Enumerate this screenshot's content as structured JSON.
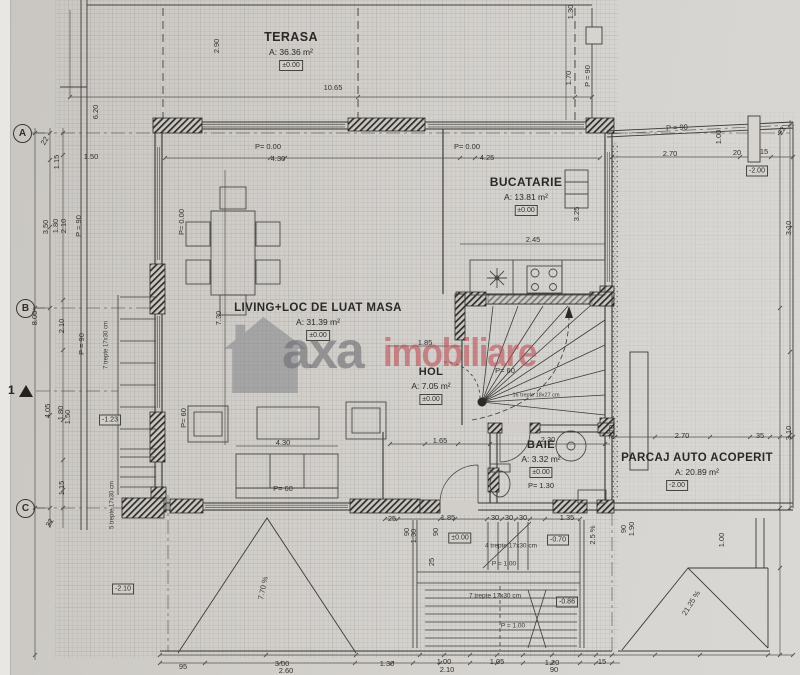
{
  "watermark": {
    "gray": "axa",
    "red": "imobiliare"
  },
  "section": {
    "label": "1"
  },
  "axes": [
    {
      "label": "A",
      "x": 22,
      "y": 133
    },
    {
      "label": "B",
      "x": 25,
      "y": 308
    },
    {
      "label": "C",
      "x": 25,
      "y": 508
    }
  ],
  "rooms": [
    {
      "key": "terasa",
      "name": "TERASA",
      "area": "A: 36.36 m²",
      "level": "±0.00",
      "x": 291,
      "y": 38,
      "size": 12.5
    },
    {
      "key": "bucatarie",
      "name": "BUCATARIE",
      "area": "A: 13.81 m²",
      "level": "±0.00",
      "x": 526,
      "y": 183,
      "size": 12
    },
    {
      "key": "living",
      "name": "LIVING+LOC DE LUAT MASA",
      "area": "A: 31.39 m²",
      "level": "±0.00",
      "x": 318,
      "y": 310,
      "size": 11.5
    },
    {
      "key": "hol",
      "name": "HOL",
      "area": "A: 7.05 m²",
      "level": "±0.00",
      "x": 431,
      "y": 374,
      "size": 11
    },
    {
      "key": "baie",
      "name": "BAIE",
      "area": "A: 3.32 m²",
      "level": "±0.00",
      "extra": "P= 1.30",
      "x": 541,
      "y": 447,
      "size": 11
    },
    {
      "key": "parcaj",
      "name": "PARCAJ AUTO ACOPERIT",
      "area": "A: 20.89 m²",
      "level": "-2.00",
      "x": 697,
      "y": 460,
      "size": 11.5,
      "level_dx": -20
    }
  ],
  "levels": [
    {
      "t": "-1.23",
      "x": 110,
      "y": 420
    },
    {
      "t": "-2.10",
      "x": 123,
      "y": 589
    },
    {
      "t": "±0.00",
      "x": 460,
      "y": 538
    },
    {
      "t": "-0.70",
      "x": 558,
      "y": 540
    },
    {
      "t": "-0.86",
      "x": 567,
      "y": 602
    },
    {
      "t": "-2.00",
      "x": 757,
      "y": 171
    }
  ],
  "annotations": [
    {
      "t": "16 trepte 18x27 cm",
      "x": 536,
      "y": 396,
      "s": 5.5
    },
    {
      "t": "4 trepte 17x30 cm",
      "x": 511,
      "y": 546,
      "s": 6.5
    },
    {
      "t": "P = 1.00",
      "x": 504,
      "y": 564,
      "s": 6.5
    },
    {
      "t": "7 trepte 17x30 cm",
      "x": 495,
      "y": 596,
      "s": 6.5
    },
    {
      "t": "P = 1.00",
      "x": 513,
      "y": 626,
      "s": 6.5
    },
    {
      "t": "7 trepte 17x30 cm",
      "x": 107,
      "y": 345,
      "r": -90,
      "s": 6
    },
    {
      "t": "5 trepte 17x30 cm",
      "x": 113,
      "y": 505,
      "r": -90,
      "s": 6
    },
    {
      "t": "7.70 %",
      "x": 263,
      "y": 588,
      "r": -78,
      "s": 7.5
    },
    {
      "t": "21.25 %",
      "x": 691,
      "y": 603,
      "r": -58,
      "s": 7.5
    }
  ],
  "dimensions": [
    {
      "t": "10.65",
      "x": 333,
      "y": 88
    },
    {
      "t": "2.90",
      "x": 217,
      "y": 46,
      "r": -90
    },
    {
      "t": "6.20",
      "x": 96,
      "y": 112,
      "r": -90
    },
    {
      "t": "1.50",
      "x": 91,
      "y": 157
    },
    {
      "t": "22",
      "x": 45,
      "y": 141,
      "r": -60
    },
    {
      "t": "1.15",
      "x": 57,
      "y": 162,
      "r": -90
    },
    {
      "t": "3.50",
      "x": 46,
      "y": 227,
      "r": -90
    },
    {
      "t": "1.80",
      "x": 56,
      "y": 226,
      "r": -90
    },
    {
      "t": "2.10",
      "x": 64,
      "y": 226,
      "r": -90
    },
    {
      "t": "P = 90",
      "x": 79,
      "y": 226,
      "r": -90
    },
    {
      "t": "8.00",
      "x": 35,
      "y": 318,
      "r": -90
    },
    {
      "t": "2.10",
      "x": 62,
      "y": 326,
      "r": -90
    },
    {
      "t": "P = 90",
      "x": 82,
      "y": 344,
      "r": -90
    },
    {
      "t": "4.05",
      "x": 48,
      "y": 411,
      "r": -90
    },
    {
      "t": "1.80",
      "x": 61,
      "y": 413,
      "r": -90
    },
    {
      "t": "1.50",
      "x": 68,
      "y": 417,
      "r": -90
    },
    {
      "t": "1.15",
      "x": 62,
      "y": 488,
      "r": -90
    },
    {
      "t": "22",
      "x": 50,
      "y": 523,
      "r": -60
    },
    {
      "t": "P= 0.00",
      "x": 268,
      "y": 147
    },
    {
      "t": "4.30",
      "x": 278,
      "y": 159
    },
    {
      "t": "P= 0.00",
      "x": 467,
      "y": 147
    },
    {
      "t": "4.25",
      "x": 487,
      "y": 158
    },
    {
      "t": "P= 0.00",
      "x": 182,
      "y": 222,
      "r": -90
    },
    {
      "t": "2.45",
      "x": 533,
      "y": 240
    },
    {
      "t": "3.25",
      "x": 577,
      "y": 214,
      "r": -90
    },
    {
      "t": "1.30",
      "x": 571,
      "y": 12,
      "r": -90
    },
    {
      "t": "1.70",
      "x": 569,
      "y": 78,
      "r": -90
    },
    {
      "t": "P = 90",
      "x": 588,
      "y": 76,
      "r": -90
    },
    {
      "t": "2.70",
      "x": 670,
      "y": 154
    },
    {
      "t": "20",
      "x": 737,
      "y": 153
    },
    {
      "t": "15",
      "x": 764,
      "y": 152
    },
    {
      "t": "1.00",
      "x": 719,
      "y": 137,
      "r": -90
    },
    {
      "t": "22",
      "x": 782,
      "y": 131,
      "r": -60
    },
    {
      "t": "P = 90",
      "x": 677,
      "y": 128,
      "r": -3
    },
    {
      "t": "7.30",
      "x": 219,
      "y": 318,
      "r": -90
    },
    {
      "t": "4.30",
      "x": 283,
      "y": 443
    },
    {
      "t": "1.85",
      "x": 425,
      "y": 343
    },
    {
      "t": "P= 60",
      "x": 283,
      "y": 489
    },
    {
      "t": "P= 60",
      "x": 184,
      "y": 418,
      "r": -90
    },
    {
      "t": "1.65",
      "x": 440,
      "y": 441
    },
    {
      "t": "2.30",
      "x": 548,
      "y": 440
    },
    {
      "t": "P= 60",
      "x": 505,
      "y": 371
    },
    {
      "t": "25",
      "x": 392,
      "y": 519
    },
    {
      "t": "1.85",
      "x": 448,
      "y": 518
    },
    {
      "t": "30",
      "x": 495,
      "y": 518
    },
    {
      "t": "30",
      "x": 509,
      "y": 518
    },
    {
      "t": "30",
      "x": 523,
      "y": 518
    },
    {
      "t": "1.35",
      "x": 567,
      "y": 518
    },
    {
      "t": "90",
      "x": 407,
      "y": 532,
      "r": -90
    },
    {
      "t": "1.30",
      "x": 414,
      "y": 536,
      "r": -90
    },
    {
      "t": "90",
      "x": 436,
      "y": 532,
      "r": -90
    },
    {
      "t": "25",
      "x": 432,
      "y": 562,
      "r": -90
    },
    {
      "t": "2.5 %",
      "x": 593,
      "y": 535,
      "r": -90
    },
    {
      "t": "95",
      "x": 183,
      "y": 667
    },
    {
      "t": "3.00",
      "x": 282,
      "y": 664
    },
    {
      "t": "2.60",
      "x": 286,
      "y": 671
    },
    {
      "t": "1.30",
      "x": 387,
      "y": 664
    },
    {
      "t": "1.00",
      "x": 444,
      "y": 662
    },
    {
      "t": "2.10",
      "x": 447,
      "y": 670
    },
    {
      "t": "1.05",
      "x": 497,
      "y": 662
    },
    {
      "t": "1.20",
      "x": 552,
      "y": 663
    },
    {
      "t": "90",
      "x": 554,
      "y": 670
    },
    {
      "t": "15",
      "x": 602,
      "y": 662
    },
    {
      "t": "2.70",
      "x": 682,
      "y": 436
    },
    {
      "t": "35",
      "x": 760,
      "y": 436
    },
    {
      "t": "3.10",
      "x": 612,
      "y": 432,
      "r": -90
    },
    {
      "t": "90",
      "x": 624,
      "y": 529,
      "r": -90
    },
    {
      "t": "1.90",
      "x": 632,
      "y": 529,
      "r": -90
    },
    {
      "t": "1.00",
      "x": 722,
      "y": 540,
      "r": -90
    },
    {
      "t": "3.10",
      "x": 789,
      "y": 228,
      "r": -90
    },
    {
      "t": "3.10",
      "x": 789,
      "y": 433,
      "r": -90
    }
  ]
}
